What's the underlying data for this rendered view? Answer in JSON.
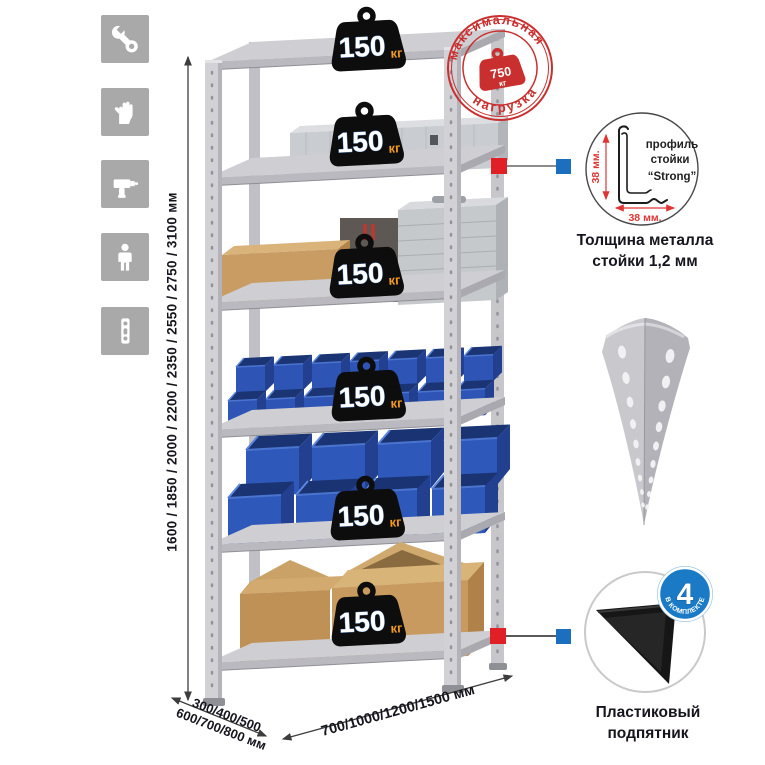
{
  "left_icons": [
    {
      "icon": "wrench-icon"
    },
    {
      "icon": "gloves-icon"
    },
    {
      "icon": "drill-icon"
    },
    {
      "icon": "person-icon"
    },
    {
      "icon": "perforated-profile-icon"
    }
  ],
  "dimensions": {
    "height_label": "1600 / 1850 / 2000 / 2200 / 2350 / 2550 / 2750 / 3100 мм",
    "depth_line1": "300/400/500",
    "depth_line2": "600/700/800 мм",
    "width_label": "700/1000/1200/1500 мм"
  },
  "shelves": [
    {
      "load": "150",
      "unit": "кг"
    },
    {
      "load": "150",
      "unit": "кг"
    },
    {
      "load": "150",
      "unit": "кг"
    },
    {
      "load": "150",
      "unit": "кг"
    },
    {
      "load": "150",
      "unit": "кг"
    },
    {
      "load": "150",
      "unit": "кг"
    }
  ],
  "max_load_stamp": {
    "arc_top": "максимальная",
    "arc_bottom": "нагрузка",
    "value": "750",
    "unit": "кг"
  },
  "profile_detail": {
    "label_line1": "профиль",
    "label_line2": "стойки",
    "label_line3": "“Strong”",
    "vertical_dim": "38 мм.",
    "horizontal_dim": "38 мм.",
    "caption_line1": "Толщина металла",
    "caption_line2": "стойки 1,2 мм"
  },
  "included_badge": {
    "count": "4",
    "arc_text": "в комплекте"
  },
  "plastic_foot": {
    "caption_line1": "Пластиковый",
    "caption_line2": "подпятник"
  },
  "colors": {
    "stamp_red": "#c92f2f",
    "marker_red": "#e01f26",
    "marker_blue": "#1c6fbe",
    "badge_black": "#0d0d0d",
    "badge_unit_orange": "#f49a1c",
    "bin_blue": "#2e55b6",
    "cardboard_tan": "#c89c63",
    "metal_gray": "#cfcfd4",
    "included_badge_blue": "#1a7ac6",
    "dim_text": "#15151d",
    "icon_tile_gray": "#a9a9a9"
  }
}
